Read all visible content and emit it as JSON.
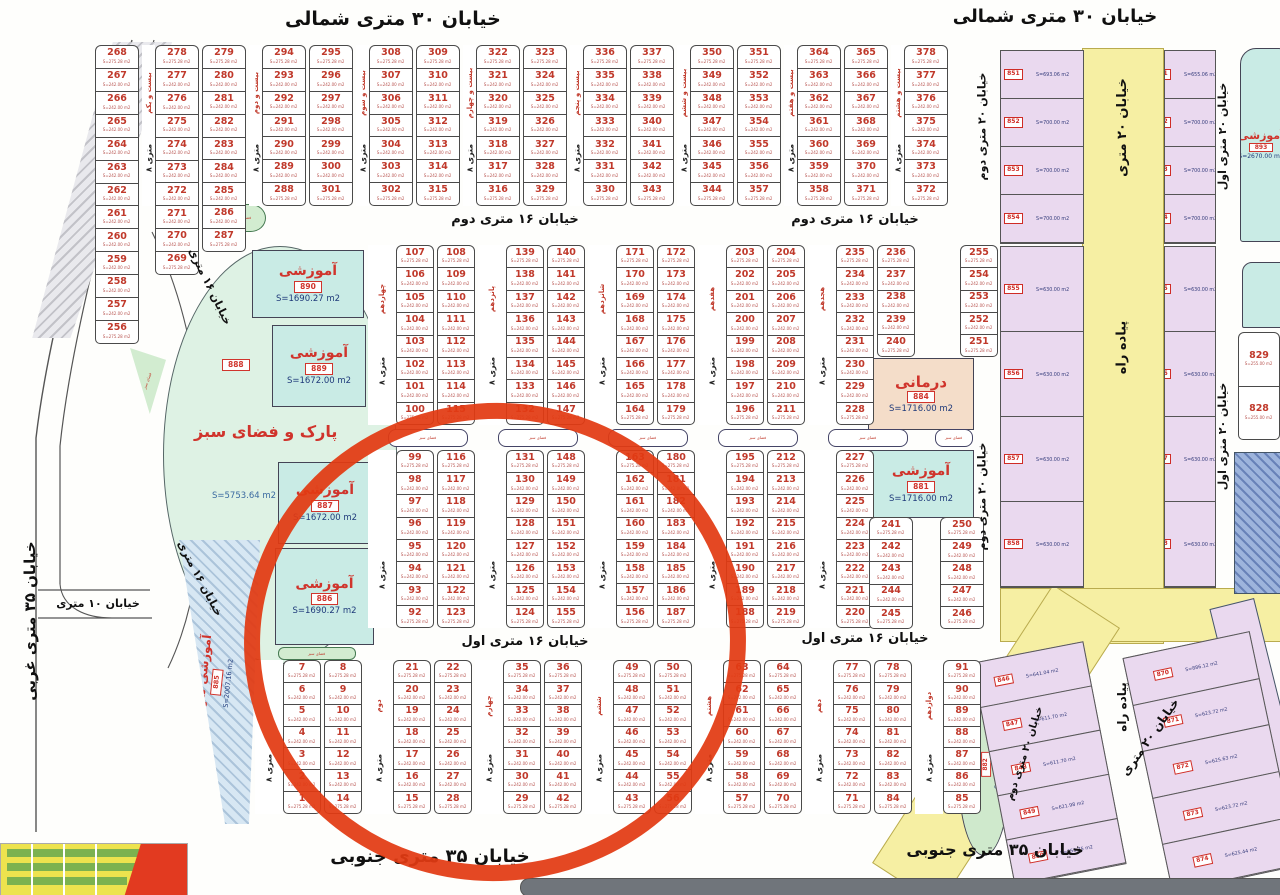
{
  "streets": {
    "north30": "خیابان ۳۰ متری شمالی",
    "south35": "خیابان ۳۵ متری جنوبی",
    "west35": "خیابان ۳۵ متری غربی",
    "s16_1": "خیابان ۱۶ متری اول",
    "s16_2": "خیابان ۱۶ متری دوم",
    "s16": "خیابان ۱۶ متری",
    "s10": "خیابان ۱۰ متری",
    "s20": "خیابان ۲۰ متری",
    "s20_1": "خیابان ۲۰ متری اول",
    "s20_2": "خیابان ۲۰ متری دوم",
    "ped": "پیاده راه",
    "alley8": "۸ متری"
  },
  "zones": {
    "services": {
      "label": "خدمات شهری _ اداری",
      "code": "895"
    },
    "park": {
      "label": "پارک و فضای سبز",
      "code": "888",
      "area": "S=5753.64 m2"
    },
    "edu890": {
      "label": "آموزشی",
      "code": "890",
      "area": "S=1690.27 m2"
    },
    "edu889": {
      "label": "آموزشی",
      "code": "889",
      "area": "S=1672.00 m2"
    },
    "edu887": {
      "label": "آموزشی",
      "code": "887",
      "area": "S=1672.00 m2"
    },
    "edu886": {
      "label": "آموزشی",
      "code": "886",
      "area": "S=1690.27 m2"
    },
    "edu881": {
      "label": "آموزشی",
      "code": "881",
      "area": "S=1716.00 m2"
    },
    "eduR": {
      "label": "آموزشی",
      "code": "893",
      "area": "S=2670.00 m2"
    },
    "eduUrban": {
      "label": "آموزشی شهری",
      "code": "885",
      "area": "S=2007.16 m2"
    },
    "clinic": {
      "label": "درمانی",
      "code": "884",
      "area": "S=1716.00 m2"
    },
    "greenSE": {
      "label": "فضای سبز",
      "code": "882",
      "area": "S=1933.26 m2"
    },
    "green": {
      "label": "فضای سبز"
    }
  },
  "area_defaults": {
    "top": "S=275.28 m2",
    "mid": "S=242.00 m2",
    "bottom": "S=275.28 m2"
  },
  "blocks": [
    {
      "id": "ul",
      "items": [
        {
          "c": [
            "268",
            "267",
            "266",
            "265",
            "264",
            "263",
            "262",
            "261",
            "260",
            "259",
            "258",
            "257",
            "256"
          ]
        },
        {
          "a": "بیست و یکم"
        },
        {
          "c": [
            "278",
            "277",
            "276",
            "275",
            "274",
            "273",
            "272",
            "271",
            "270",
            "269"
          ]
        },
        {
          "c": [
            "279",
            "280",
            "281",
            "282",
            "283",
            "284",
            "285",
            "286",
            "287"
          ]
        },
        {
          "a": "بیست و دوم"
        },
        {
          "c": [
            "294",
            "293",
            "292",
            "291",
            "290",
            "289",
            "288"
          ]
        },
        {
          "c": [
            "295",
            "296",
            "297",
            "298",
            "299",
            "300",
            "301"
          ]
        },
        {
          "a": "بیست و سوم"
        },
        {
          "c": [
            "308",
            "307",
            "306",
            "305",
            "304",
            "303",
            "302"
          ]
        },
        {
          "c": [
            "309",
            "310",
            "311",
            "312",
            "313",
            "314",
            "315"
          ]
        },
        {
          "a": "بیست و چهارم"
        },
        {
          "c": [
            "322",
            "321",
            "320",
            "319",
            "318",
            "317",
            "316"
          ]
        },
        {
          "c": [
            "323",
            "324",
            "325",
            "326",
            "327",
            "328",
            "329"
          ]
        },
        {
          "a": "بیست و پنجم"
        },
        {
          "c": [
            "336",
            "335",
            "334",
            "333",
            "332",
            "331",
            "330"
          ]
        },
        {
          "c": [
            "337",
            "338",
            "339",
            "340",
            "341",
            "342",
            "343"
          ]
        },
        {
          "a": "بیست و ششم"
        },
        {
          "c": [
            "350",
            "349",
            "348",
            "347",
            "346",
            "345",
            "344"
          ]
        },
        {
          "c": [
            "351",
            "352",
            "353",
            "354",
            "355",
            "356",
            "357"
          ]
        },
        {
          "a": "بیست و هفتم"
        },
        {
          "c": [
            "364",
            "363",
            "362",
            "361",
            "360",
            "359",
            "358"
          ]
        },
        {
          "c": [
            "365",
            "366",
            "367",
            "368",
            "369",
            "370",
            "371"
          ]
        },
        {
          "a": "بیست و هشتم"
        },
        {
          "c": [
            "378",
            "377",
            "376",
            "375",
            "374",
            "373",
            "372"
          ]
        }
      ]
    },
    {
      "id": "ct",
      "items": [
        {
          "a": "چهاردهم"
        },
        {
          "c": [
            "107",
            "106",
            "105",
            "104",
            "103",
            "102",
            "101",
            "100"
          ]
        },
        {
          "c": [
            "108",
            "109",
            "110",
            "111",
            "112",
            "113",
            "114",
            "115"
          ]
        },
        {
          "a": "پانزدهم"
        },
        {
          "c": [
            "139",
            "138",
            "137",
            "136",
            "135",
            "134",
            "133",
            "132"
          ]
        },
        {
          "c": [
            "140",
            "141",
            "142",
            "143",
            "144",
            "145",
            "146",
            "147"
          ]
        },
        {
          "a": "شانزدهم"
        },
        {
          "c": [
            "171",
            "170",
            "169",
            "168",
            "167",
            "166",
            "165",
            "164"
          ]
        },
        {
          "c": [
            "172",
            "173",
            "174",
            "175",
            "176",
            "177",
            "178",
            "179"
          ]
        },
        {
          "a": "هفدهم"
        },
        {
          "c": [
            "203",
            "202",
            "201",
            "200",
            "199",
            "198",
            "197",
            "196"
          ]
        },
        {
          "c": [
            "204",
            "205",
            "206",
            "207",
            "208",
            "209",
            "210",
            "211"
          ]
        },
        {
          "a": "هجدهم"
        },
        {
          "c": [
            "235",
            "234",
            "233",
            "232",
            "231",
            "230",
            "229",
            "228"
          ]
        },
        {
          "c": [
            "236",
            "237",
            "238",
            "239",
            "240"
          ]
        },
        {
          "s": 1
        },
        {
          "c": [
            "255",
            "254",
            "253",
            "252",
            "251"
          ]
        }
      ]
    },
    {
      "id": "cb",
      "items": [
        {
          "a": ""
        },
        {
          "c": [
            "99",
            "98",
            "97",
            "96",
            "95",
            "94",
            "93",
            "92"
          ]
        },
        {
          "c": [
            "116",
            "117",
            "118",
            "119",
            "120",
            "121",
            "122",
            "123"
          ]
        },
        {
          "a": ""
        },
        {
          "c": [
            "131",
            "130",
            "129",
            "128",
            "127",
            "126",
            "125",
            "124"
          ]
        },
        {
          "c": [
            "148",
            "149",
            "150",
            "151",
            "152",
            "153",
            "154",
            "155"
          ]
        },
        {
          "a": ""
        },
        {
          "c": [
            "163",
            "162",
            "161",
            "160",
            "159",
            "158",
            "157",
            "156"
          ]
        },
        {
          "c": [
            "180",
            "181",
            "182",
            "183",
            "184",
            "185",
            "186",
            "187"
          ]
        },
        {
          "a": ""
        },
        {
          "c": [
            "195",
            "194",
            "193",
            "192",
            "191",
            "190",
            "189",
            "188"
          ]
        },
        {
          "c": [
            "212",
            "213",
            "214",
            "215",
            "216",
            "217",
            "218",
            "219"
          ]
        },
        {
          "a": ""
        },
        {
          "c": [
            "227",
            "226",
            "225",
            "224",
            "223",
            "222",
            "221",
            "220"
          ]
        }
      ]
    },
    {
      "id": "cb5",
      "items": [
        {
          "c": [
            "241",
            "242",
            "243",
            "244",
            "245"
          ]
        },
        {
          "s": 1
        },
        {
          "c": [
            "250",
            "249",
            "248",
            "247",
            "246"
          ]
        }
      ]
    },
    {
      "id": "sb",
      "items": [
        {
          "a": ""
        },
        {
          "c": [
            "7",
            "6",
            "5",
            "4",
            "3",
            "2",
            "1"
          ]
        },
        {
          "c": [
            "8",
            "9",
            "10",
            "11",
            "12",
            "13",
            "14"
          ]
        },
        {
          "a": "دوم"
        },
        {
          "c": [
            "21",
            "20",
            "19",
            "18",
            "17",
            "16",
            "15"
          ]
        },
        {
          "c": [
            "22",
            "23",
            "24",
            "25",
            "26",
            "27",
            "28"
          ]
        },
        {
          "a": "چهارم"
        },
        {
          "c": [
            "35",
            "34",
            "33",
            "32",
            "31",
            "30",
            "29"
          ]
        },
        {
          "c": [
            "36",
            "37",
            "38",
            "39",
            "40",
            "41",
            "42"
          ]
        },
        {
          "a": "ششم"
        },
        {
          "c": [
            "49",
            "48",
            "47",
            "46",
            "45",
            "44",
            "43"
          ]
        },
        {
          "c": [
            "50",
            "51",
            "52",
            "53",
            "54",
            "55",
            "56"
          ]
        },
        {
          "a": "هشتم"
        },
        {
          "c": [
            "63",
            "62",
            "61",
            "60",
            "59",
            "58",
            "57"
          ]
        },
        {
          "c": [
            "64",
            "65",
            "66",
            "67",
            "68",
            "69",
            "70"
          ]
        },
        {
          "a": "دهم"
        },
        {
          "c": [
            "77",
            "76",
            "75",
            "74",
            "73",
            "72",
            "71"
          ]
        },
        {
          "c": [
            "78",
            "79",
            "80",
            "81",
            "82",
            "83",
            "84"
          ]
        },
        {
          "a": "دوازدهم"
        },
        {
          "c": [
            "91",
            "90",
            "89",
            "88",
            "87",
            "86",
            "85"
          ]
        }
      ]
    },
    {
      "id": "r8",
      "areas": {
        "top": "S=255.00 m2",
        "mid": "S=255.00 m2",
        "bottom": "S=255.00 m2"
      },
      "items": [
        {
          "c": [
            "829",
            "828"
          ]
        }
      ]
    }
  ],
  "pink": {
    "a_top": [
      {
        "code": "851",
        "area": "S=693.06 m2"
      },
      {
        "code": "852",
        "area": "S=700.00 m2"
      },
      {
        "code": "853",
        "area": "S=700.00 m2"
      },
      {
        "code": "854",
        "area": "S=700.00 m2"
      }
    ],
    "a_mid": [
      {
        "code": "855",
        "area": "S=630.00 m2"
      },
      {
        "code": "856",
        "area": "S=630.00 m2"
      },
      {
        "code": "857",
        "area": "S=630.00 m2"
      },
      {
        "code": "858",
        "area": "S=630.00 m2"
      }
    ],
    "a_low": [
      {
        "code": "846",
        "area": "S=641.04 m2"
      },
      {
        "code": "847",
        "area": "S=611.70 m2"
      },
      {
        "code": "848",
        "area": "S=611.70 m2"
      },
      {
        "code": "849",
        "area": "S=621.98 m2"
      },
      {
        "code": "850",
        "area": "S=655.75 m2"
      }
    ],
    "b_top": [
      {
        "code": "861",
        "area": "S=655.06 m2"
      },
      {
        "code": "862",
        "area": "S=700.00 m2"
      },
      {
        "code": "863",
        "area": "S=700.00 m2"
      },
      {
        "code": "864",
        "area": "S=700.00 m2"
      }
    ],
    "b_mid": [
      {
        "code": "865",
        "area": "S=630.00 m2"
      },
      {
        "code": "866",
        "area": "S=630.00 m2"
      },
      {
        "code": "867",
        "area": "S=630.00 m2"
      },
      {
        "code": "868",
        "area": "S=630.00 m2"
      }
    ],
    "b_low": [
      {
        "code": "870",
        "area": "S=886.12 m2"
      },
      {
        "code": "871",
        "area": "S=623.72 m2"
      },
      {
        "code": "872",
        "area": "S=625.63 m2"
      },
      {
        "code": "873",
        "area": "S=623.72 m2"
      },
      {
        "code": "874",
        "area": "S=625.44 m2"
      }
    ]
  }
}
